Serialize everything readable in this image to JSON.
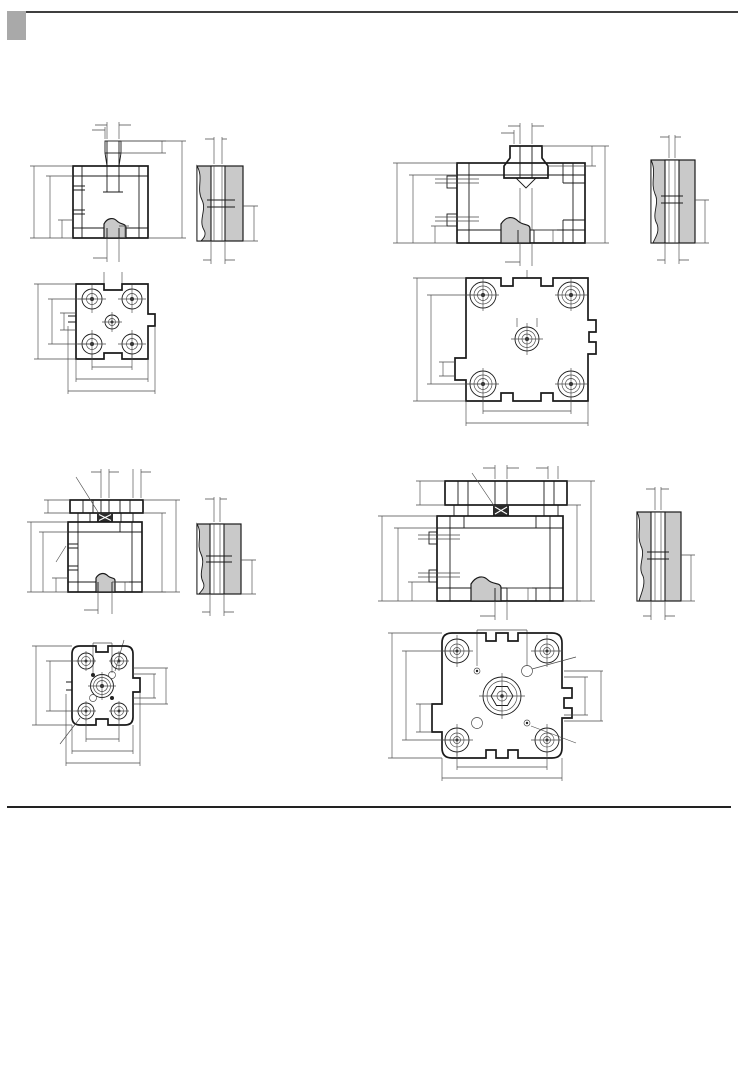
{
  "page": {
    "section_title": "外形尺寸图",
    "unit_label": "单位：mm"
  },
  "drawings": {
    "et_small": {
      "title": "ET–16~25"
    },
    "et_large": {
      "title": "ET–32~100"
    },
    "etl_small": {
      "title": "ETL–16~25"
    },
    "etl_large": {
      "title": "ETL–32~100"
    }
  },
  "dim": {
    "phiD": "φD",
    "phiD1": "φD1",
    "phiD4": "φD4",
    "phiD8": "φD8",
    "phiD9": "φD9",
    "phiD10": "φD10",
    "D2": "D2",
    "D3": "D3",
    "D5": "D5",
    "E1": "E1",
    "twoE1": "2-E1",
    "F": "F",
    "F1": "F1+",
    "H": "H+",
    "H1": "H1+",
    "H2": "H2",
    "H3": "H3+",
    "L": "L",
    "L1": "L1",
    "L2": "L2",
    "L3": "L3",
    "SW": "SW",
    "T": "T",
    "T2": "T2",
    "T3": "T3"
  },
  "table": {
    "headers": [
      "缸筒\n内径\n(mm)",
      "D",
      "D1",
      "D2",
      "D3",
      "D4",
      "D5",
      "D9H9",
      "D9",
      "D10H9",
      "E1",
      "F",
      "F1",
      "H",
      "H1",
      "H2",
      "H3",
      "L",
      "L1",
      "L2",
      "L3",
      "SW",
      "T",
      "T2",
      "T3"
    ],
    "rows": [
      [
        "16",
        "8",
        "3.2",
        "M4",
        "M4",
        "3",
        "M3",
        "6",
        "4",
        "8",
        "M5",
        "8",
        "30",
        "38",
        "42.5",
        "18.5",
        "48.5",
        "29",
        "21",
        "30",
        "9.9",
        "7",
        "8",
        "4",
        "4.2"
      ],
      [
        "20",
        "10",
        "4.2",
        "M5",
        "M5",
        "4",
        "M4",
        "6",
        "5",
        "10",
        "M5",
        "8",
        "30",
        "38",
        "42.5",
        "18.5",
        "50.5",
        "36",
        "24",
        "37.5",
        "12",
        "8",
        "10",
        "4",
        "5.7"
      ],
      [
        "25",
        "10",
        "4.2",
        "M5",
        "M5",
        "5",
        "M5",
        "6",
        "5",
        "14",
        "M5",
        "8",
        "31.5",
        "39.5",
        "45",
        "18.5",
        "53",
        "40",
        "29",
        "41.5",
        "15.6",
        "8",
        "10",
        "4",
        "4.8"
      ],
      [
        "32",
        "12",
        "5.2",
        "M6",
        "M6",
        "5",
        "M5",
        "6",
        "6",
        "17",
        "G1/8",
        "8",
        "36.5",
        "44.5",
        "50.5",
        "21.5",
        "60.5",
        "50",
        "36",
        "52",
        "19.8",
        "10",
        "12",
        "4",
        "6.1"
      ],
      [
        "40",
        "12",
        "5.2",
        "M6",
        "M6",
        "5",
        "M5",
        "6",
        "6",
        "17",
        "G1/8",
        "8",
        "37.5",
        "45.5",
        "52",
        "21.5",
        "62",
        "60",
        "42",
        "62.5",
        "23.3",
        "10",
        "12",
        "4",
        "6.1"
      ],
      [
        "50",
        "16",
        "6.2",
        "M8",
        "M8",
        "6",
        "M6",
        "6",
        "8",
        "22",
        "G1/8",
        "8",
        "37.5",
        "45.5",
        "53",
        "22",
        "65",
        "68",
        "50",
        "71",
        "29.7",
        "13",
        "12",
        "4",
        "7.6"
      ],
      [
        "63",
        "16",
        "8.5",
        "M10",
        "M8",
        "6",
        "M6",
        "8",
        "10",
        "22",
        "G1/8",
        "8",
        "42",
        "50",
        "57.5",
        "24.5",
        "69.5",
        "87",
        "62",
        "91",
        "35.4",
        "13",
        "12",
        "4",
        "7.6"
      ],
      [
        "80",
        "20",
        "8.5",
        "M10",
        "M10",
        "8",
        "M8",
        "8",
        "12",
        "28",
        "G1/8",
        "8.5",
        "47.5",
        "56",
        "64",
        "27.5",
        "78",
        "107",
        "82",
        "111",
        "46",
        "17",
        "14",
        "4",
        "8.7"
      ],
      [
        "100",
        "25",
        "8.5",
        "M10",
        "M12",
        "10",
        "M10",
        "8",
        "12",
        "30",
        "G1/4",
        "10.5",
        "56",
        "66.5",
        "76.5",
        "32.5",
        "90.5",
        "128",
        "103",
        "133",
        "56.6",
        "22",
        "16",
        "4",
        "10.3"
      ]
    ]
  }
}
